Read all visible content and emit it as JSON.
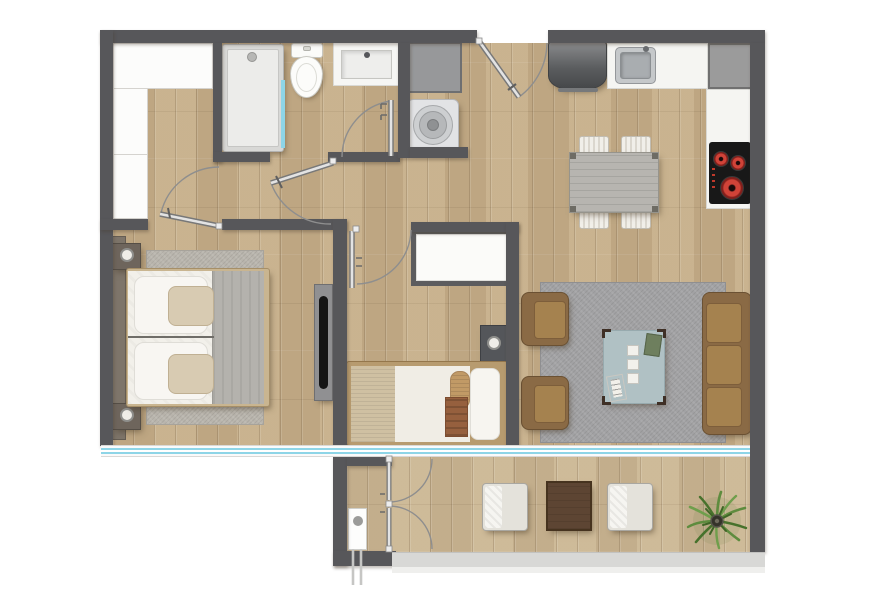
{
  "plan": {
    "type": "apartment-floor-plan",
    "view": "top-down-render",
    "rooms": [
      {
        "name": "entry-hall",
        "items": [
          "wardrobe-closet"
        ]
      },
      {
        "name": "bathroom",
        "items": [
          "shower",
          "toilet",
          "vanity-sink",
          "glass-screen"
        ]
      },
      {
        "name": "laundry-closet",
        "items": [
          "washing-machine",
          "utility-cabinet",
          "closet-door"
        ]
      },
      {
        "name": "kitchen",
        "items": [
          "refrigerator",
          "sink-counter",
          "corner-cabinet",
          "cooktop"
        ]
      },
      {
        "name": "dining-area",
        "items": [
          "dining-table",
          "chair",
          "chair",
          "chair",
          "chair"
        ]
      },
      {
        "name": "living-room",
        "items": [
          "sofa-3-seat",
          "armchair",
          "armchair",
          "coffee-table",
          "rug",
          "magazines",
          "coasters"
        ]
      },
      {
        "name": "bedroom-1",
        "items": [
          "double-bed",
          "headboard",
          "nightstand",
          "nightstand",
          "table-lamp",
          "table-lamp",
          "tv-panel",
          "rug",
          "window"
        ]
      },
      {
        "name": "bedroom-2",
        "items": [
          "single-bed",
          "closet",
          "nightstand",
          "table-lamp",
          "window"
        ]
      },
      {
        "name": "balcony",
        "items": [
          "lounge-chair",
          "lounge-chair",
          "side-table",
          "potted-plant",
          "parapet"
        ]
      },
      {
        "name": "storage-terrace",
        "items": [
          "french-doors",
          "utility-connection"
        ]
      }
    ],
    "doors": [
      "entrance-door",
      "bedroom-1-door",
      "bedroom-2-door",
      "bathroom-door",
      "laundry-door",
      "storage-french-doors"
    ],
    "palette": {
      "wall": "#57575a",
      "wood_floor": "#c5ae8a",
      "balcony_floor": "#cbb795",
      "glazing_teal": "#8ed5e7",
      "living_rug": "#a2a2a4",
      "bedroom_rug": "#b9b5ad",
      "sofa_brown": "#8a6a45",
      "cushion_brown": "#a5824f",
      "coffee_table_teal": "#b0c1c4",
      "dining_table_gray": "#b7b5b0",
      "counter_white": "#f5f5f2",
      "appliance_gray": "#6a6c6e",
      "cooktop_black": "#181818",
      "burner_red": "#d04338",
      "duvet_white": "#f2f0ea",
      "blanket_gray": "#b4b2ad",
      "blanket_beige": "#cfc0a2",
      "throw_brown": "#96603e",
      "bed_frame_tan": "#b79b6f",
      "plant_green": "#5e8c3e",
      "parapet_gray": "#d8d8d6"
    }
  }
}
